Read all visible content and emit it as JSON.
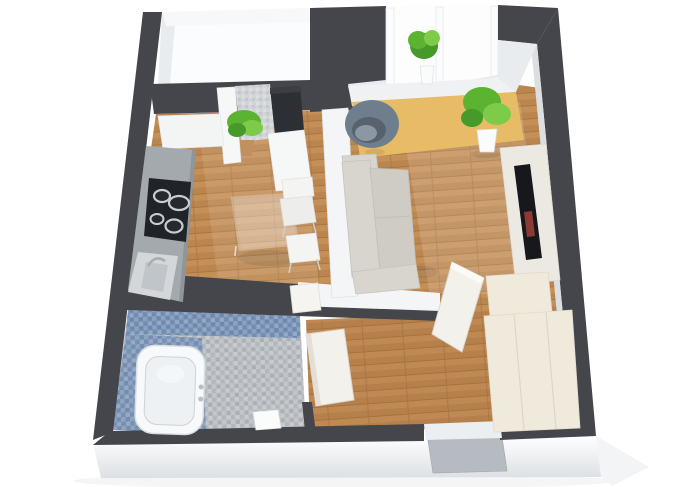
{
  "scene": {
    "kind": "3d-floor-plan-render",
    "view": "isometric-top-down",
    "subject": "one-room-studio-apartment"
  },
  "colors": {
    "background": "#ffffff",
    "wall": "#44464c",
    "interior_white": "#f4f5f6",
    "interior_shade": "#e9ecee",
    "wall_face_light": "#dcdfe2",
    "bay_white": "#fbfcfd",
    "plinth_top": "#ffffff",
    "plinth_bottom": "#dce0e4",
    "plinth_side": "#f2f4f6",
    "entry_door": "#b5bbc1",
    "wood_base": "#bf8a52",
    "wood_seam": "#a1703f",
    "rug": "#e8bc67",
    "tile_blue": "#7d96b8",
    "tile_blue_light": "#8ba3c3",
    "tile_blue_dark": "#6e88ac",
    "tile_gray": "#bdc1c5",
    "tile_niche": "#d2d5d8",
    "counter": "#a4a9ad",
    "counter_edge": "#8f969b",
    "cooktop": "#202327",
    "burner": "#c9cdd0",
    "sink": "#d3d7da",
    "sink_bowl": "#bfc5c9",
    "appliance": "#2c2f33",
    "glass_edge": "#ecedee",
    "chair": "#f4f4f2",
    "sofa": "#d8d5cf",
    "sofa_seat": "#cfccc5",
    "sofa_trim": "#c2bfb8",
    "armchair": "#6f7e8c",
    "armchair_dark": "#57626e",
    "plant": "#5cb231",
    "plant_light": "#7ecb49",
    "plant_dark": "#47992a",
    "pot_white": "#fafbfb",
    "pot_clay": "#c0905e",
    "tv_unit": "#ece9e2",
    "tv": "#17181b",
    "tv_accent": "#8d3a34",
    "wardrobe": "#efeadb",
    "wardrobe_seam": "#ddd6c2",
    "door_panel": "#f3f1eb",
    "door_edge": "#dbd7cd",
    "tub": "#f7f9fa",
    "tub_inner": "#edf1f4",
    "tub_line": "#ccd3d8",
    "mat": "#fafbfb",
    "shadow": "rgba(30,40,50,0.10)"
  },
  "rooms": [
    {
      "name": "kitchen",
      "floor": "wood",
      "furniture": [
        "kitchen-counter",
        "cooktop-4-burners",
        "kitchen-sink",
        "upper-cabinet",
        "glass-dining-table",
        "white-chair",
        "white-stool",
        "niche-dark-appliance",
        "niche-mosaic-wall",
        "niche-potted-plant"
      ]
    },
    {
      "name": "living-room",
      "floor": "wood",
      "rug": "yellow",
      "furniture": [
        "sofa",
        "swivel-armchair",
        "yellow-rug",
        "tv-cabinet",
        "tv",
        "floor-plant",
        "windowsill-plant",
        "window-bay"
      ]
    },
    {
      "name": "bathroom",
      "floor": "mosaic-tile",
      "furniture": [
        "bathtub",
        "bath-mat"
      ]
    },
    {
      "name": "hallway",
      "floor": "wood",
      "furniture": [
        "wardrobe-closet",
        "upper-closet",
        "open-door-living",
        "open-door-bathroom",
        "open-door-small",
        "entry-door"
      ]
    },
    {
      "name": "window-bay-top-left",
      "floor": "white"
    }
  ]
}
